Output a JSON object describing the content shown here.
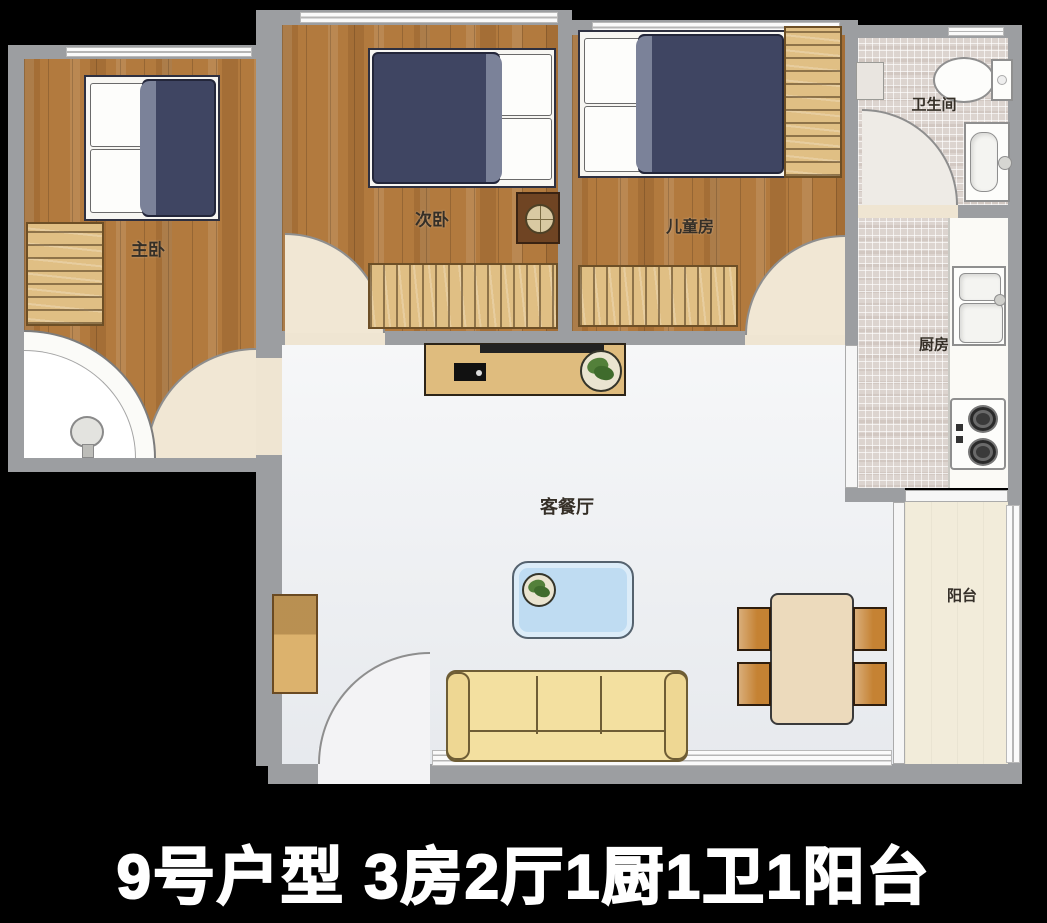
{
  "caption": "9号户型  3房2厅1厨1卫1阳台",
  "rooms": {
    "master_bedroom": {
      "label": "主卧"
    },
    "second_bedroom": {
      "label": "次卧"
    },
    "children_room": {
      "label": "儿童房"
    },
    "bathroom": {
      "label": "卫生间"
    },
    "kitchen": {
      "label": "厨房"
    },
    "living_dining": {
      "label": "客餐厅"
    },
    "balcony": {
      "label": "阳台"
    }
  },
  "summary": {
    "unit_number": "9号户型",
    "bedrooms": 3,
    "halls": 2,
    "kitchens": 1,
    "bathrooms": 1,
    "balconies": 1
  },
  "furniture_icons": {
    "master_bedroom": [
      "double-bed-icon",
      "wardrobe-icon",
      "corner-shower-icon"
    ],
    "second_bedroom": [
      "double-bed-icon",
      "nightstand-icon",
      "wardrobe-icon"
    ],
    "children_room": [
      "double-bed-icon",
      "wardrobe-icon",
      "closet-icon"
    ],
    "bathroom": [
      "toilet-icon",
      "washbasin-icon"
    ],
    "kitchen": [
      "kitchen-sink-icon",
      "stove-icon",
      "counter"
    ],
    "living_dining": [
      "tv-cabinet-icon",
      "tv-icon",
      "potted-plant-icon",
      "coffee-table-icon",
      "sofa-icon",
      "dining-table-icon",
      "dining-chair-icon",
      "shoe-cabinet-icon"
    ]
  },
  "colors": {
    "background": "#000000",
    "wall": "#9c9ea1",
    "wood_floor": "#b27a3e",
    "tile_floor": "#dcd4cf",
    "living_floor": "#edeff2",
    "balcony_floor": "#f2ecda",
    "bed_duvet": "#3f4562",
    "sofa": "#f3e0a0",
    "coffee_table": "#bfdcf2",
    "door_arc": "#f1e7d4",
    "caption_text": "#ffffff"
  }
}
